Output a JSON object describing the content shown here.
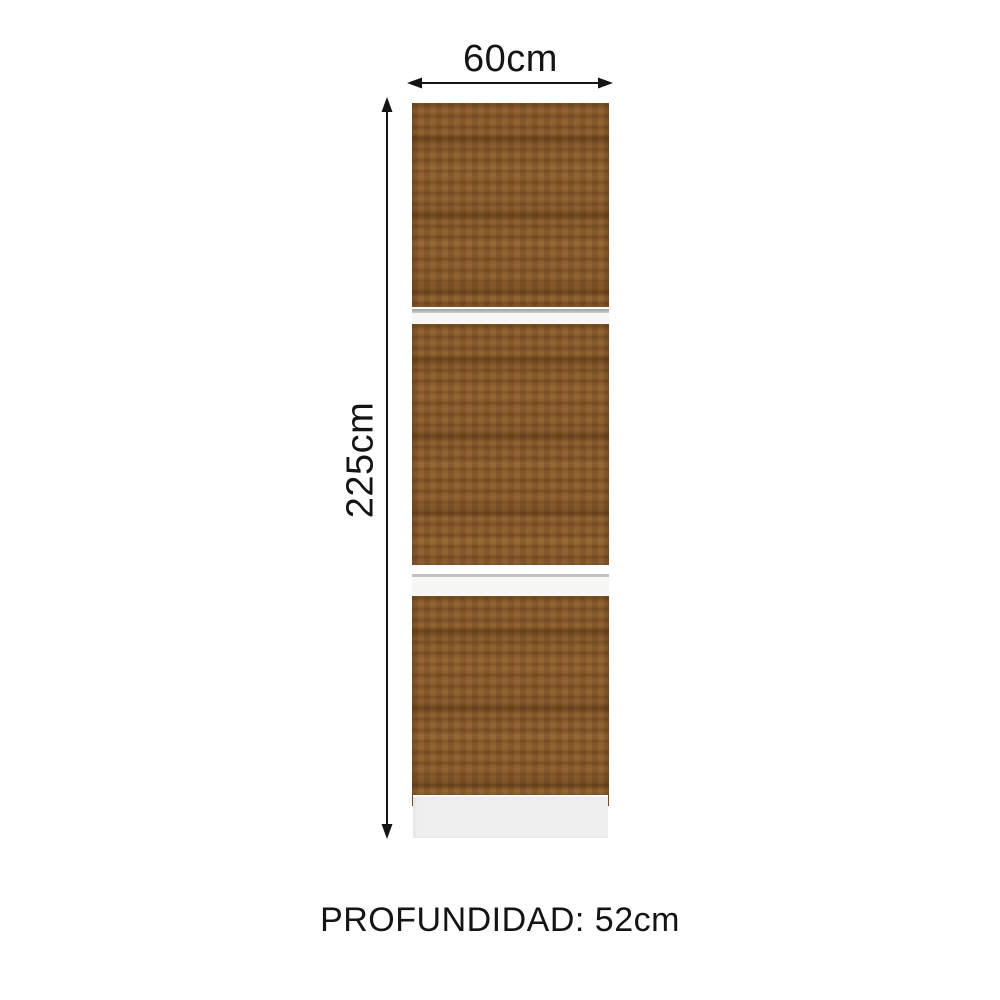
{
  "dimensions": {
    "width": "60cm",
    "height": "225cm",
    "depth": "PROFUNDIDAD: 52cm"
  },
  "cabinet": {
    "door_count": 3,
    "gap_count": 2
  },
  "colors": {
    "wood": "#8d5e2e",
    "wood_dark": "#6b421a",
    "wood_light": "#a97e49",
    "gap_background": "#f7f7f5",
    "gap_line": "#c2c2c2",
    "base": "#efefef",
    "arrow_and_text": "#141414",
    "background": "#ffffff"
  }
}
